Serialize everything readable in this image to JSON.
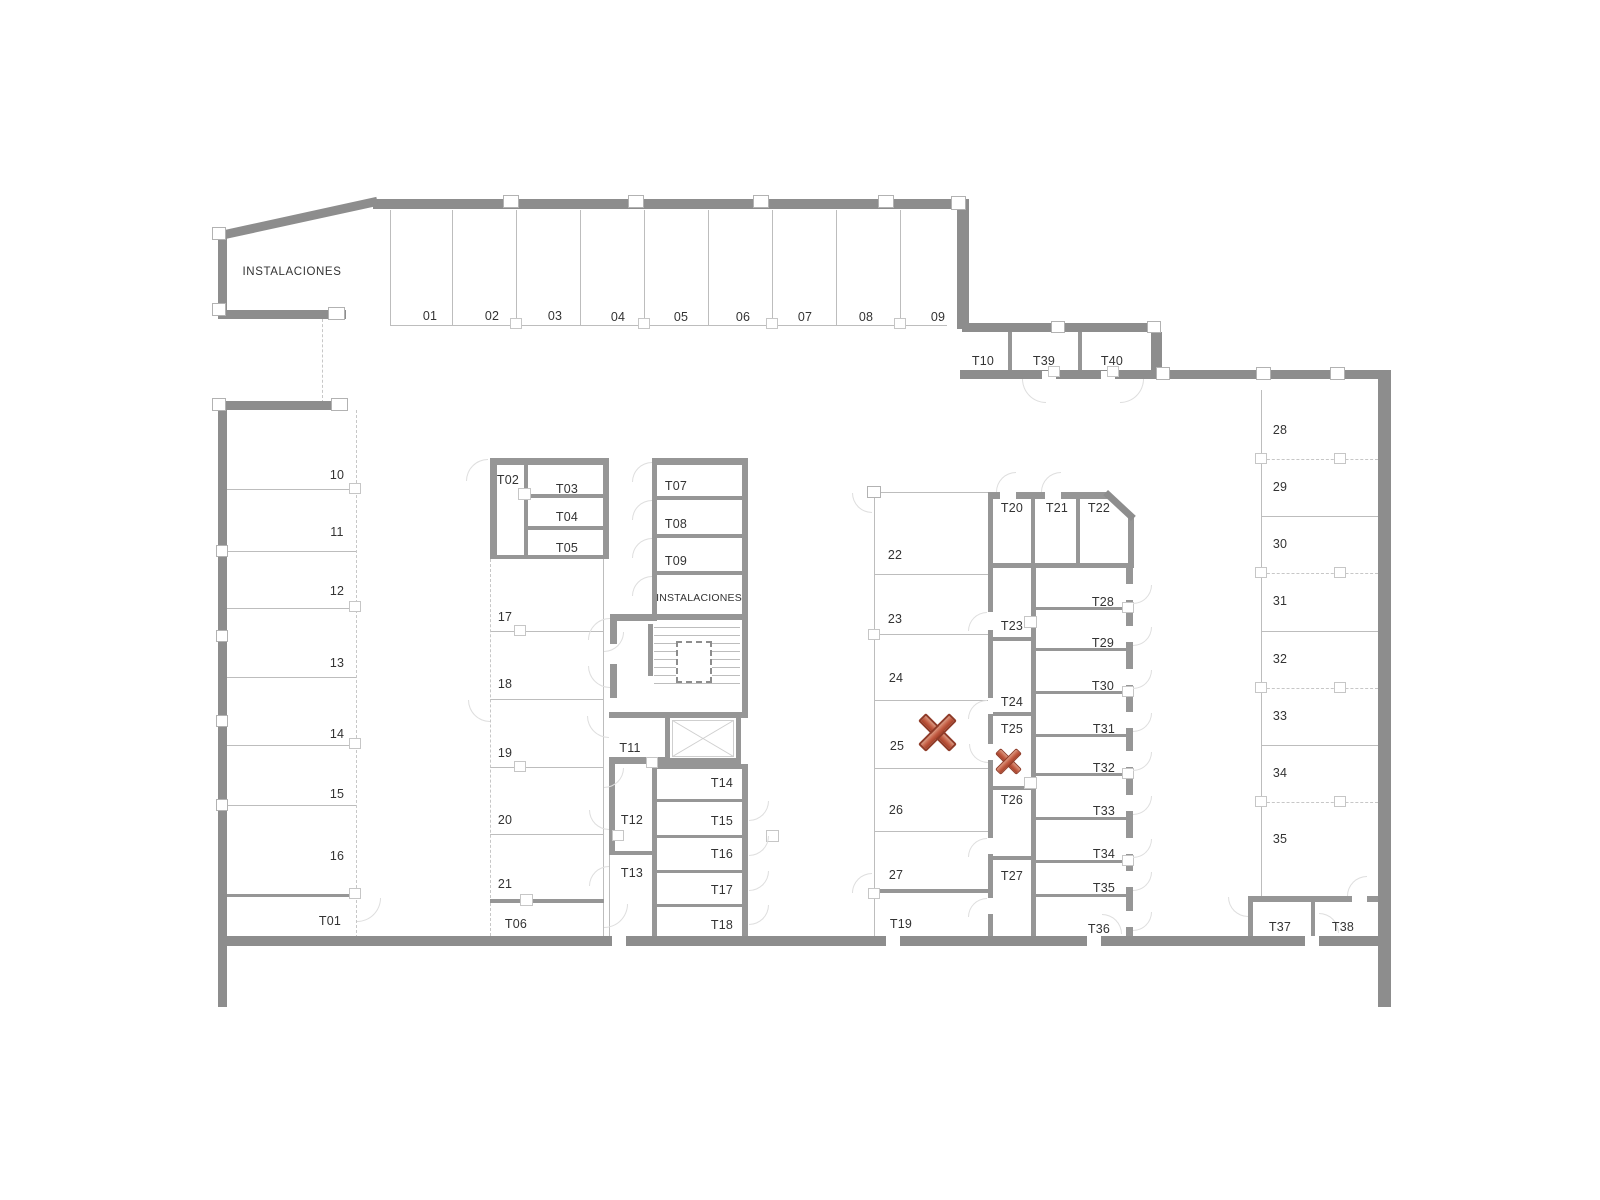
{
  "document": {
    "type": "architectural floor plan",
    "floor_use": "parking and storage level"
  },
  "colors": {
    "background": "#ffffff",
    "wall": "#8d8d8d",
    "partition": "#969696",
    "thin_line": "#bdbdbd",
    "dashed_line": "#c7c7c7",
    "door_arc": "#dedede",
    "label_text": "#333333",
    "marker_light": "#db987f",
    "marker_mid": "#c25b42",
    "marker_dark": "#a44129",
    "marker_stroke": "#8f3b28"
  },
  "spaces": [
    {
      "label": "INSTALACIONES",
      "x": 292,
      "y": 272,
      "kind": "inst",
      "group": "top-left-room"
    },
    {
      "label": "01",
      "x": 430,
      "y": 316,
      "group": "top-row"
    },
    {
      "label": "02",
      "x": 492,
      "y": 316,
      "group": "top-row"
    },
    {
      "label": "03",
      "x": 555,
      "y": 316,
      "group": "top-row"
    },
    {
      "label": "04",
      "x": 618,
      "y": 317,
      "group": "top-row"
    },
    {
      "label": "05",
      "x": 681,
      "y": 317,
      "group": "top-row"
    },
    {
      "label": "06",
      "x": 743,
      "y": 317,
      "group": "top-row"
    },
    {
      "label": "07",
      "x": 805,
      "y": 317,
      "group": "top-row"
    },
    {
      "label": "08",
      "x": 866,
      "y": 317,
      "group": "top-row"
    },
    {
      "label": "09",
      "x": 938,
      "y": 317,
      "group": "top-row"
    },
    {
      "label": "T10",
      "x": 983,
      "y": 361,
      "group": "annex-top"
    },
    {
      "label": "T39",
      "x": 1044,
      "y": 361,
      "group": "annex-top"
    },
    {
      "label": "T40",
      "x": 1112,
      "y": 361,
      "group": "annex-top"
    },
    {
      "label": "10",
      "x": 337,
      "y": 475,
      "group": "left-column"
    },
    {
      "label": "11",
      "x": 337,
      "y": 532,
      "group": "left-column"
    },
    {
      "label": "12",
      "x": 337,
      "y": 591,
      "group": "left-column"
    },
    {
      "label": "13",
      "x": 337,
      "y": 663,
      "group": "left-column"
    },
    {
      "label": "14",
      "x": 337,
      "y": 734,
      "group": "left-column"
    },
    {
      "label": "15",
      "x": 337,
      "y": 794,
      "group": "left-column"
    },
    {
      "label": "16",
      "x": 337,
      "y": 856,
      "group": "left-column"
    },
    {
      "label": "T01",
      "x": 330,
      "y": 921,
      "group": "left-column"
    },
    {
      "label": "T02",
      "x": 508,
      "y": 480,
      "group": "storage-block-a"
    },
    {
      "label": "T03",
      "x": 567,
      "y": 489,
      "group": "storage-block-a"
    },
    {
      "label": "T04",
      "x": 567,
      "y": 517,
      "group": "storage-block-a"
    },
    {
      "label": "T05",
      "x": 567,
      "y": 548,
      "group": "storage-block-a"
    },
    {
      "label": "17",
      "x": 505,
      "y": 617,
      "group": "mid-left-column"
    },
    {
      "label": "18",
      "x": 505,
      "y": 684,
      "group": "mid-left-column"
    },
    {
      "label": "19",
      "x": 505,
      "y": 753,
      "group": "mid-left-column"
    },
    {
      "label": "20",
      "x": 505,
      "y": 820,
      "group": "mid-left-column"
    },
    {
      "label": "21",
      "x": 505,
      "y": 884,
      "group": "mid-left-column"
    },
    {
      "label": "T06",
      "x": 516,
      "y": 924,
      "group": "mid-left-column"
    },
    {
      "label": "T07",
      "x": 676,
      "y": 486,
      "group": "storage-block-b"
    },
    {
      "label": "T08",
      "x": 676,
      "y": 524,
      "group": "storage-block-b"
    },
    {
      "label": "T09",
      "x": 676,
      "y": 561,
      "group": "storage-block-b"
    },
    {
      "label": "INSTALACIONES",
      "x": 699,
      "y": 598,
      "kind": "inst2",
      "group": "storage-block-b"
    },
    {
      "label": "T11",
      "x": 630,
      "y": 748,
      "group": "core"
    },
    {
      "label": "T12",
      "x": 632,
      "y": 820,
      "group": "core"
    },
    {
      "label": "T13",
      "x": 632,
      "y": 873,
      "group": "core"
    },
    {
      "label": "T14",
      "x": 722,
      "y": 783,
      "group": "storage-block-c"
    },
    {
      "label": "T15",
      "x": 722,
      "y": 821,
      "group": "storage-block-c"
    },
    {
      "label": "T16",
      "x": 722,
      "y": 854,
      "group": "storage-block-c"
    },
    {
      "label": "T17",
      "x": 722,
      "y": 890,
      "group": "storage-block-c"
    },
    {
      "label": "T18",
      "x": 722,
      "y": 925,
      "group": "storage-block-c"
    },
    {
      "label": "22",
      "x": 895,
      "y": 555,
      "group": "mid-parking"
    },
    {
      "label": "23",
      "x": 895,
      "y": 619,
      "group": "mid-parking"
    },
    {
      "label": "24",
      "x": 896,
      "y": 678,
      "group": "mid-parking"
    },
    {
      "label": "25",
      "x": 897,
      "y": 746,
      "group": "mid-parking"
    },
    {
      "label": "26",
      "x": 896,
      "y": 810,
      "group": "mid-parking"
    },
    {
      "label": "27",
      "x": 896,
      "y": 875,
      "group": "mid-parking"
    },
    {
      "label": "T19",
      "x": 901,
      "y": 924,
      "group": "mid-parking"
    },
    {
      "label": "T20",
      "x": 1012,
      "y": 508,
      "group": "storage-row-top"
    },
    {
      "label": "T21",
      "x": 1057,
      "y": 508,
      "group": "storage-row-top"
    },
    {
      "label": "T22",
      "x": 1099,
      "y": 508,
      "group": "storage-row-top"
    },
    {
      "label": "T23",
      "x": 1012,
      "y": 626,
      "group": "storage-inner-column"
    },
    {
      "label": "T24",
      "x": 1012,
      "y": 702,
      "group": "storage-inner-column"
    },
    {
      "label": "T25",
      "x": 1012,
      "y": 729,
      "group": "storage-inner-column"
    },
    {
      "label": "T26",
      "x": 1012,
      "y": 800,
      "group": "storage-inner-column"
    },
    {
      "label": "T27",
      "x": 1012,
      "y": 876,
      "group": "storage-inner-column"
    },
    {
      "label": "T28",
      "x": 1103,
      "y": 602,
      "group": "storage-east-column"
    },
    {
      "label": "T29",
      "x": 1103,
      "y": 643,
      "group": "storage-east-column"
    },
    {
      "label": "T30",
      "x": 1103,
      "y": 686,
      "group": "storage-east-column"
    },
    {
      "label": "T31",
      "x": 1104,
      "y": 729,
      "group": "storage-east-column"
    },
    {
      "label": "T32",
      "x": 1104,
      "y": 768,
      "group": "storage-east-column"
    },
    {
      "label": "T33",
      "x": 1104,
      "y": 811,
      "group": "storage-east-column"
    },
    {
      "label": "T34",
      "x": 1104,
      "y": 854,
      "group": "storage-east-column"
    },
    {
      "label": "T35",
      "x": 1104,
      "y": 888,
      "group": "storage-east-column"
    },
    {
      "label": "T36",
      "x": 1099,
      "y": 929,
      "group": "storage-east-column"
    },
    {
      "label": "28",
      "x": 1280,
      "y": 430,
      "group": "right-column"
    },
    {
      "label": "29",
      "x": 1280,
      "y": 487,
      "group": "right-column"
    },
    {
      "label": "30",
      "x": 1280,
      "y": 544,
      "group": "right-column"
    },
    {
      "label": "31",
      "x": 1280,
      "y": 601,
      "group": "right-column"
    },
    {
      "label": "32",
      "x": 1280,
      "y": 659,
      "group": "right-column"
    },
    {
      "label": "33",
      "x": 1280,
      "y": 716,
      "group": "right-column"
    },
    {
      "label": "34",
      "x": 1280,
      "y": 773,
      "group": "right-column"
    },
    {
      "label": "35",
      "x": 1280,
      "y": 839,
      "group": "right-column"
    },
    {
      "label": "T37",
      "x": 1280,
      "y": 927,
      "group": "right-column"
    },
    {
      "label": "T38",
      "x": 1343,
      "y": 927,
      "group": "right-column"
    }
  ],
  "markers": [
    {
      "id": "x-marker-large",
      "x": 937,
      "y": 732,
      "span": 33,
      "bar_length": 44,
      "bar_thickness": 11,
      "marked_space": "25"
    },
    {
      "id": "x-marker-small",
      "x": 1008,
      "y": 761,
      "span": 23,
      "bar_length": 30,
      "bar_thickness": 8,
      "marked_space": "T25"
    }
  ]
}
